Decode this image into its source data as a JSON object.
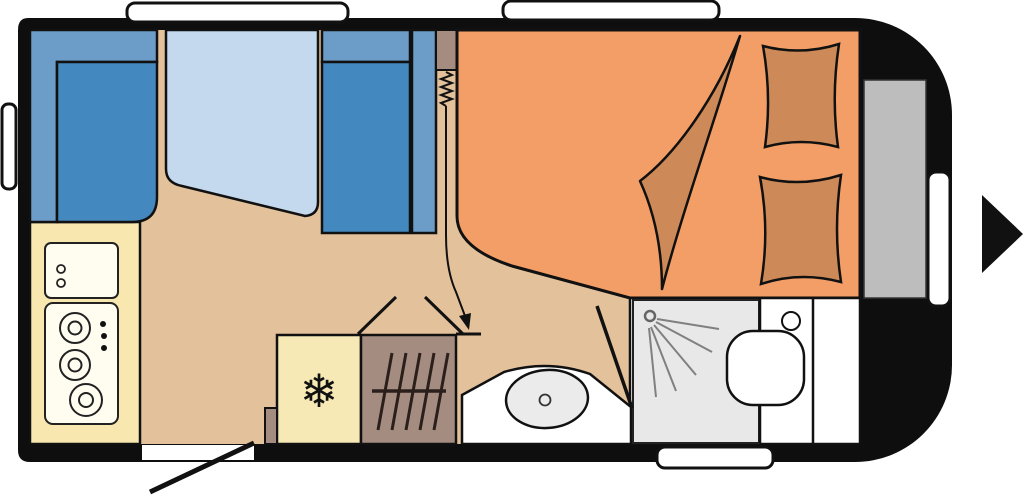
{
  "floorplan": {
    "colors": {
      "wall": "#0e0e0e",
      "floor": "#e3c19b",
      "seat": "#4389bf",
      "seat_back": "#6c9dc8",
      "table": "#c4d8ee",
      "bed": "#f29e66",
      "bedding": "#cd8a58",
      "kitchen": "#f8e8b0",
      "appliance": "#fffdf0",
      "fridge": "#f6e9b6",
      "heater": "#a58c80",
      "shower": "#e8e8e8",
      "bathroom": "#ffffff",
      "storage": "#bdbdbd",
      "window": "#ffffff",
      "arrow": "#111111"
    },
    "glyphs": {
      "snowflake": "❄"
    }
  }
}
